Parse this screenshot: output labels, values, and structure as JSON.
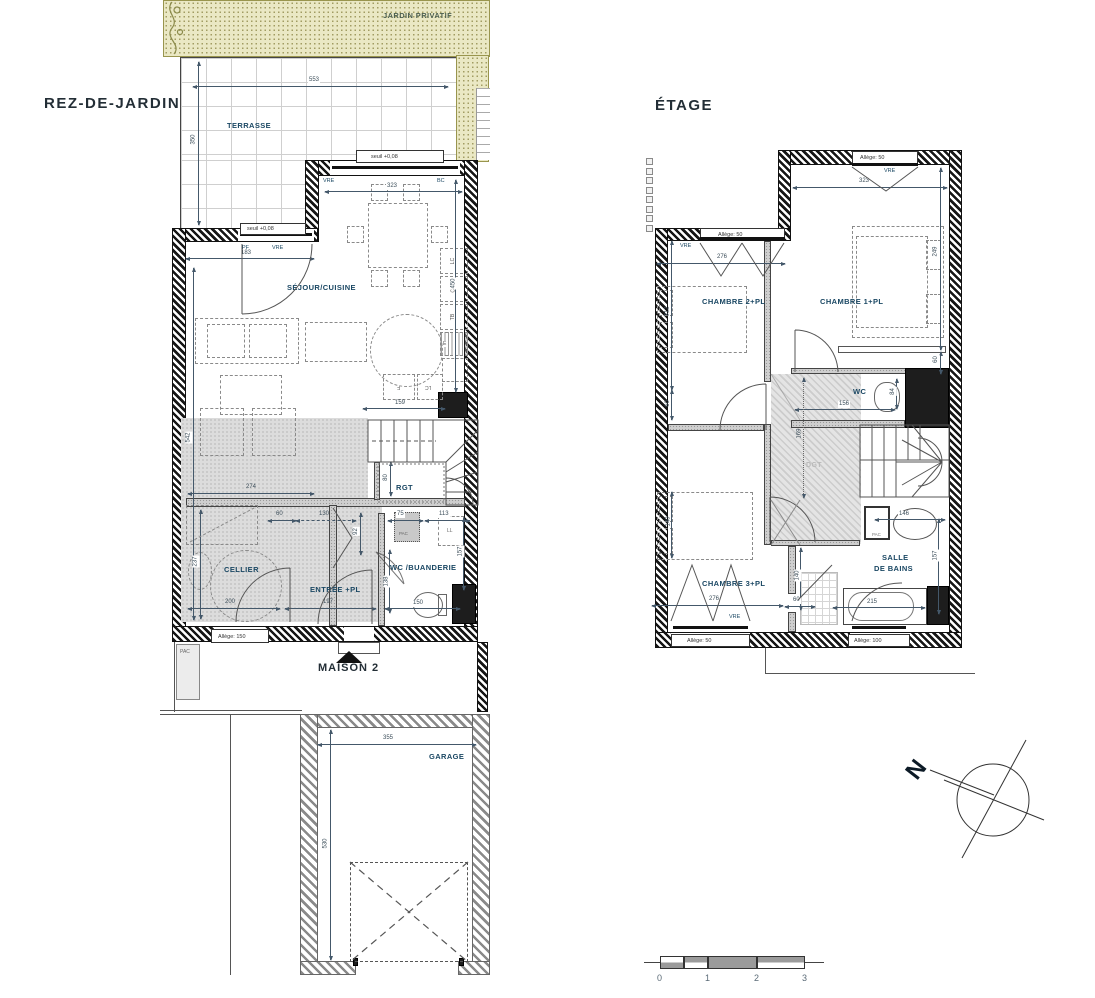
{
  "titles": {
    "rdj": "REZ-DE-JARDIN",
    "etage": "ÉTAGE",
    "maison": "MAISON 2",
    "jardin": "JARDIN PRIVATIF"
  },
  "colors": {
    "wall": "#161616",
    "room_label": "#1a4763",
    "dim_text": "#3c4e5a",
    "jardin_fill": "#eae8c4",
    "jardin_dot": "#a19c62",
    "jardin_text": "#4c5f50",
    "gray_zone": "#dcdcdc"
  },
  "rdj": {
    "rooms": {
      "terrasse": "TERRASSE",
      "sejour": "SÉJOUR/CUISINE",
      "cellier": "CELLIER",
      "entree": "ENTRÉE +PL",
      "wc": "WC /BUANDERIE",
      "rgt": "RGT",
      "garage": "GARAGE"
    },
    "labels": {
      "seuil": "seuil +0,08",
      "vre": "VRE",
      "bc": "BC",
      "pf": "PF",
      "pac": "PAC",
      "ll": "LL",
      "allege150": "Allège: 150",
      "k_lc": "LC",
      "k_cu": "CU",
      "k_tb": "TB",
      "k_e": "E",
      "k_f": "F",
      "k_lc2": "LC"
    },
    "dims": {
      "d553": "553",
      "d350": "350",
      "d323": "323",
      "d183": "183",
      "d542": "542",
      "d450": "450",
      "d159": "159",
      "d274": "274",
      "d60": "60",
      "d130": "130",
      "d75": "75",
      "d113": "113",
      "d92": "92",
      "d157": "157",
      "d237": "237",
      "d200": "200",
      "d197": "197",
      "d150": "150",
      "d138": "138",
      "d80": "80",
      "d355": "355",
      "d530": "530"
    }
  },
  "etage": {
    "rooms": {
      "ch1": "CHAMBRE 1+PL",
      "ch2": "CHAMBRE 2+PL",
      "ch3": "CHAMBRE 3+PL",
      "wc": "WC",
      "dgt": "DGT",
      "sdb_line1": "SALLE",
      "sdb_line2": "DE BAINS"
    },
    "labels": {
      "allege50": "Allège: 50",
      "allege100": "Allège: 100",
      "vre": "VRE",
      "pac": "PAC"
    },
    "dims": {
      "d323": "323",
      "d276": "276",
      "d312": "312",
      "d60": "60",
      "d249": "249",
      "d156": "156",
      "d84": "84",
      "d169": "169",
      "d140": "140",
      "d276b": "276",
      "d215": "215",
      "d146": "146",
      "d157": "157"
    }
  },
  "compass": {
    "north": "N"
  },
  "scalebar": {
    "t0": "0",
    "t1": "1",
    "t2": "2",
    "t3": "3"
  }
}
